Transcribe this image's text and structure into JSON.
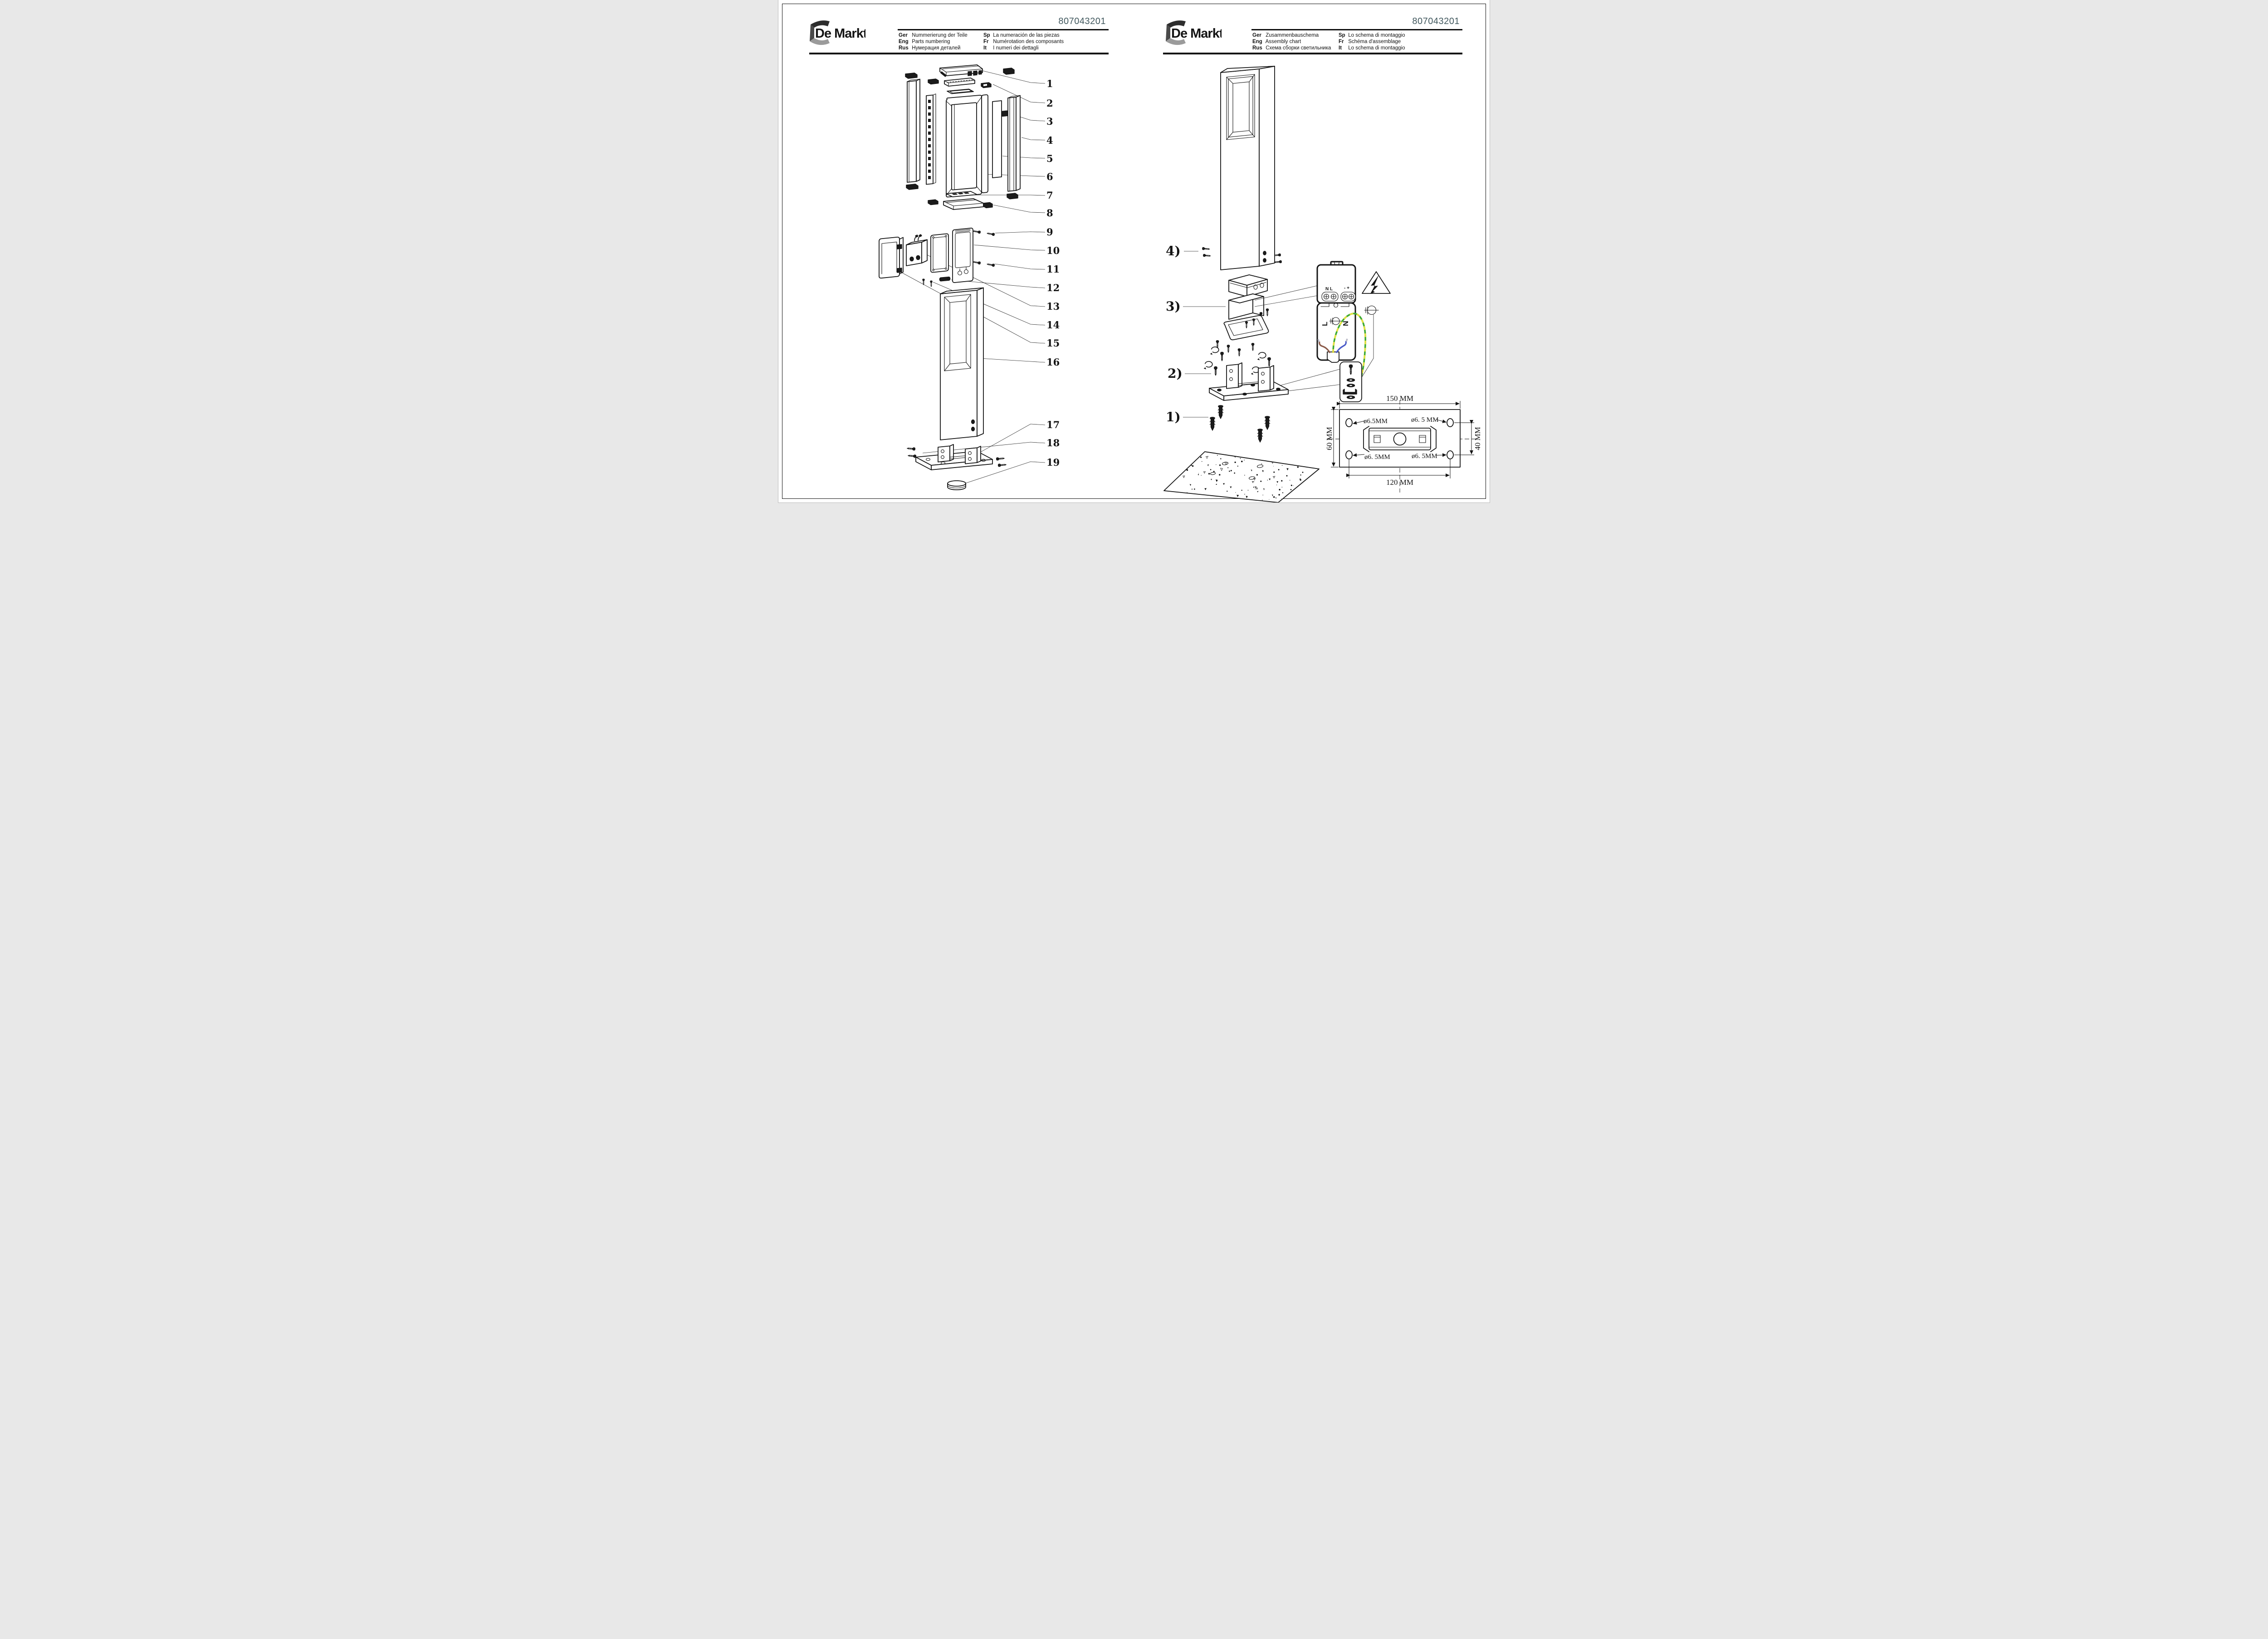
{
  "pages": {
    "left": {
      "brand": "De Markt",
      "product_code": "807043201",
      "languages": [
        {
          "code": "Ger",
          "label": "Nummerierung der Teile"
        },
        {
          "code": "Eng",
          "label": "Parts numbering"
        },
        {
          "code": "Rus",
          "label": "Нумерация деталей"
        },
        {
          "code": "Sp",
          "label": "La numeración de las piezas"
        },
        {
          "code": "Fr",
          "label": "Numérotation des composants"
        },
        {
          "code": "It",
          "label": "I numeri dei dettagli"
        }
      ],
      "part_numbers": [
        "1",
        "2",
        "3",
        "4",
        "5",
        "6",
        "7",
        "8",
        "9",
        "10",
        "11",
        "12",
        "13",
        "14",
        "15",
        "16",
        "17",
        "18",
        "19"
      ]
    },
    "right": {
      "brand": "De Markt",
      "product_code": "807043201",
      "languages": [
        {
          "code": "Ger",
          "label": "Zusammenbauschema"
        },
        {
          "code": "Eng",
          "label": "Assembly chart"
        },
        {
          "code": "Rus",
          "label": "Схема сборки светильника"
        },
        {
          "code": "Sp",
          "label": "Lo schema di montaggio"
        },
        {
          "code": "Fr",
          "label": "Schéma d'assemblage"
        },
        {
          "code": "It",
          "label": "Lo schema di montaggio"
        }
      ],
      "step_labels": [
        "1)",
        "2)",
        "3)",
        "4)"
      ],
      "terminal_labels": {
        "input": "N L",
        "output": "- +",
        "line": "L",
        "neutral": "N"
      },
      "dimensions": {
        "width": "150 MM",
        "height": "60 MM",
        "hole_spacing_vertical": "40 MM",
        "hole_spacing_horizontal": "120 MM",
        "hole_top_left": "ø6.5MM",
        "hole_top_right": "ø6. 5 MM",
        "hole_bottom_left": "ø6. 5MM",
        "hole_bottom_right": "ø6. 5MM"
      }
    }
  }
}
